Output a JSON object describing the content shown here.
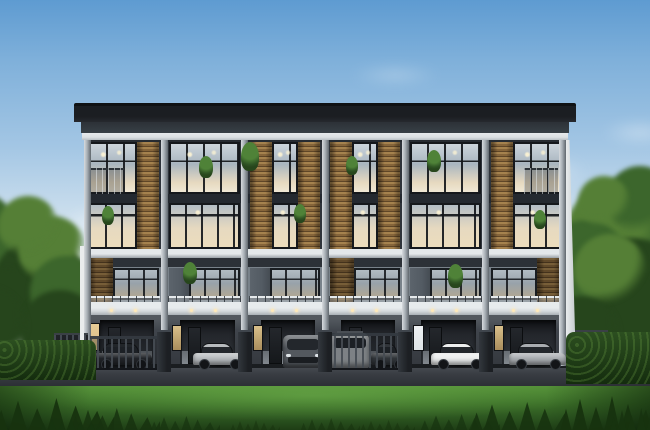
{
  "image": {
    "type": "architectural-exterior-rendering",
    "subject": "Modern four-storey townhome row with six units, glass facades, wood-slat accents, ground-floor carports with parked cars, lawn in the foreground and trees on both sides under a blue sky",
    "visible_text": "none",
    "floors": 4,
    "units_count": 6,
    "cars_count": 7
  },
  "palette": {
    "sky_top": "#5e9bd1",
    "sky_mid": "#a3c6e4",
    "sky_low": "#d8e6f0",
    "sky_horizon": "#edf2f5",
    "roof_dark": "#1b1e22",
    "roof_under": "#384046",
    "fascia_white": "#dbe0e3",
    "facade_upper": "#2f343b",
    "spandrel": "#242930",
    "frame": "#15181c",
    "glass_cool_hi": "#ccd5dc",
    "glass_cool": "#a9b5bf",
    "glass_warm": "#e6d9c0",
    "wood_hi": "#a5824e",
    "wood_mid": "#86653a",
    "wood_dark": "#5f4627",
    "pillar_hi": "#d7dbde",
    "pillar_mid": "#a9b0b6",
    "pillar_dark": "#5f666d",
    "slab": "#d5dadd",
    "slab_shadow": "#9aa1a7",
    "facade_mid_band": "#2c3137",
    "facade_mid": "#79828a",
    "panel_gray": "#535b63",
    "rail_light": "#ced3d6",
    "rail_dark": "#23272c",
    "ground_wall": "#40454c",
    "recess": "#23262b",
    "door": "#1a1d21",
    "apron": "#82888e",
    "lite_warm": "#d9bb83",
    "lite_cool": "#dfe4e7",
    "downlight": "#ffe9b8",
    "gate": "#202327",
    "gate_bar": "#454b52",
    "post": "#24272b",
    "road_hi": "#585d63",
    "road": "#3a3e44",
    "road_dark": "#26292e",
    "curb": "#b3b8bc",
    "grass_hi": "#549038",
    "grass": "#3c7029",
    "grass_dark": "#1e3d15",
    "tuft": "#17330f",
    "tree_colors": [
      "#557f36",
      "#3c662c",
      "#26451c"
    ],
    "hedge": "#1e3a17",
    "side_wall": "#e9eced",
    "car_window": "#23272c",
    "cloud": "#ffffff"
  },
  "sky": {
    "clouds": [
      {
        "x": 30,
        "y": 190,
        "w": 210,
        "h": 70,
        "o": 0.8
      },
      {
        "x": 110,
        "y": 150,
        "w": 150,
        "h": 45,
        "o": 0.5
      },
      {
        "x": 330,
        "y": 60,
        "w": 130,
        "h": 30,
        "o": 0.3
      },
      {
        "x": 410,
        "y": 140,
        "w": 210,
        "h": 65,
        "o": 0.6
      },
      {
        "x": 500,
        "y": 195,
        "w": 190,
        "h": 70,
        "o": 0.85
      },
      {
        "x": 585,
        "y": 115,
        "w": 110,
        "h": 35,
        "o": 0.4
      },
      {
        "x": -20,
        "y": 240,
        "w": 160,
        "h": 50,
        "o": 0.7
      }
    ]
  },
  "trees": {
    "left_blobs": [
      {
        "x": -28,
        "y": 238,
        "r": 48,
        "c": 1
      },
      {
        "x": -10,
        "y": 278,
        "r": 52,
        "c": 2
      },
      {
        "x": 18,
        "y": 252,
        "r": 44,
        "c": 1
      },
      {
        "x": 40,
        "y": 286,
        "r": 48,
        "c": 2
      },
      {
        "x": 8,
        "y": 314,
        "r": 46,
        "c": 2
      },
      {
        "x": 52,
        "y": 250,
        "r": 34,
        "c": 0
      },
      {
        "x": 66,
        "y": 292,
        "r": 36,
        "c": 1
      },
      {
        "x": 28,
        "y": 226,
        "r": 30,
        "c": 0
      },
      {
        "x": 60,
        "y": 330,
        "r": 40,
        "c": 2
      },
      {
        "x": -16,
        "y": 330,
        "r": 44,
        "c": 2
      }
    ],
    "right_blobs": [
      {
        "x": 648,
        "y": 250,
        "r": 60,
        "c": 1
      },
      {
        "x": 612,
        "y": 232,
        "r": 46,
        "c": 0
      },
      {
        "x": 586,
        "y": 262,
        "r": 42,
        "c": 1
      },
      {
        "x": 632,
        "y": 296,
        "r": 58,
        "c": 2
      },
      {
        "x": 596,
        "y": 308,
        "r": 48,
        "c": 2
      },
      {
        "x": 572,
        "y": 286,
        "r": 34,
        "c": 1
      },
      {
        "x": 654,
        "y": 330,
        "r": 52,
        "c": 2
      },
      {
        "x": 610,
        "y": 270,
        "r": 36,
        "c": 0
      },
      {
        "x": 580,
        "y": 336,
        "r": 40,
        "c": 2
      },
      {
        "x": 640,
        "y": 200,
        "r": 34,
        "c": 1
      },
      {
        "x": 604,
        "y": 202,
        "r": 26,
        "c": 0
      }
    ],
    "hedge_left": {
      "x": -8,
      "y": 340,
      "w": 104,
      "h": 40
    },
    "hedge_right": {
      "x": 566,
      "y": 332,
      "w": 92,
      "h": 52
    }
  },
  "building": {
    "x": 84,
    "w": 482,
    "roof_y": 103,
    "body_top": 140,
    "row1_y": 142,
    "row1_h": 52,
    "row2_y": 203,
    "row2_h": 46,
    "mid_y": 258,
    "mid_win_y": 268,
    "mid_win_h": 32,
    "ground_y": 315,
    "base_y": 366,
    "units": [
      {
        "label": "townhome-unit-1",
        "wood_top": "right",
        "wood_mid": "left",
        "sidelight": "warm-wide",
        "gate": true,
        "cars": [
          {
            "type": "sedan",
            "color": "#2a2d32",
            "x": 94,
            "w": 58
          }
        ]
      },
      {
        "label": "townhome-unit-2",
        "wood_top": "none",
        "wood_mid": "panel",
        "sidelight": "warm",
        "gate": false,
        "cars": [
          {
            "type": "sedan",
            "color": "#b7bbbe",
            "x": 193,
            "w": 52
          }
        ]
      },
      {
        "label": "townhome-unit-3",
        "wood_top": "both",
        "wood_mid": "panel",
        "sidelight": "warm",
        "gate": false,
        "cars": [
          {
            "type": "suv",
            "color": "#53585e",
            "x": 283,
            "w": 40
          }
        ]
      },
      {
        "label": "townhome-unit-4",
        "wood_top": "both",
        "wood_mid": "left",
        "sidelight": "none",
        "gate": true,
        "cars": [
          {
            "type": "van",
            "color": "#a9aeb2",
            "x": 331,
            "w": 38
          },
          {
            "type": "sedan",
            "color": "#3f4449",
            "x": 371,
            "w": 32
          }
        ]
      },
      {
        "label": "townhome-unit-5",
        "wood_top": "none",
        "wood_mid": "panel",
        "sidelight": "cool",
        "gate": false,
        "cars": [
          {
            "type": "sedan",
            "color": "#eceeee",
            "x": 431,
            "w": 55
          }
        ]
      },
      {
        "label": "townhome-unit-6",
        "wood_top": "left",
        "wood_mid": "right",
        "sidelight": "warm",
        "gate": false,
        "cars": [
          {
            "type": "sedan",
            "color": "#a9adb1",
            "x": 509,
            "w": 57
          }
        ]
      }
    ],
    "gates": [
      {
        "x": 90,
        "w": 70,
        "y": 336,
        "h": 34
      },
      {
        "x": 327,
        "w": 76,
        "y": 333,
        "h": 37
      }
    ],
    "end_fences": [
      {
        "x": 54,
        "w": 34,
        "y": 333,
        "h": 42
      },
      {
        "x": 574,
        "w": 34,
        "y": 330,
        "h": 46
      }
    ]
  },
  "plants": [
    {
      "x": 206,
      "y": 156,
      "s": 14
    },
    {
      "x": 250,
      "y": 142,
      "s": 18
    },
    {
      "x": 352,
      "y": 156,
      "s": 12
    },
    {
      "x": 434,
      "y": 150,
      "s": 14
    },
    {
      "x": 108,
      "y": 206,
      "s": 12
    },
    {
      "x": 300,
      "y": 204,
      "s": 12
    },
    {
      "x": 190,
      "y": 262,
      "s": 14
    },
    {
      "x": 455,
      "y": 264,
      "s": 15
    },
    {
      "x": 540,
      "y": 210,
      "s": 12
    }
  ],
  "ground": {
    "curb": {
      "x": 36,
      "y": 358,
      "w": 130,
      "h": 7
    },
    "tufts": [
      {
        "x": -6,
        "y": 398,
        "w": 120,
        "h": 34,
        "o": 0.95
      },
      {
        "x": 70,
        "y": 408,
        "w": 90,
        "h": 24,
        "o": 0.85
      },
      {
        "x": 150,
        "y": 416,
        "w": 70,
        "h": 16,
        "o": 0.7
      },
      {
        "x": 300,
        "y": 418,
        "w": 60,
        "h": 14,
        "o": 0.6
      },
      {
        "x": 420,
        "y": 414,
        "w": 80,
        "h": 18,
        "o": 0.7
      },
      {
        "x": 470,
        "y": 402,
        "w": 110,
        "h": 30,
        "o": 0.9
      },
      {
        "x": 560,
        "y": 396,
        "w": 100,
        "h": 36,
        "o": 0.95
      },
      {
        "x": 230,
        "y": 420,
        "w": 50,
        "h": 12,
        "o": 0.55
      },
      {
        "x": 360,
        "y": 420,
        "w": 55,
        "h": 12,
        "o": 0.55
      },
      {
        "x": 40,
        "y": 418,
        "w": 60,
        "h": 14,
        "o": 0.7
      },
      {
        "x": 610,
        "y": 408,
        "w": 60,
        "h": 24,
        "o": 0.9
      }
    ]
  }
}
